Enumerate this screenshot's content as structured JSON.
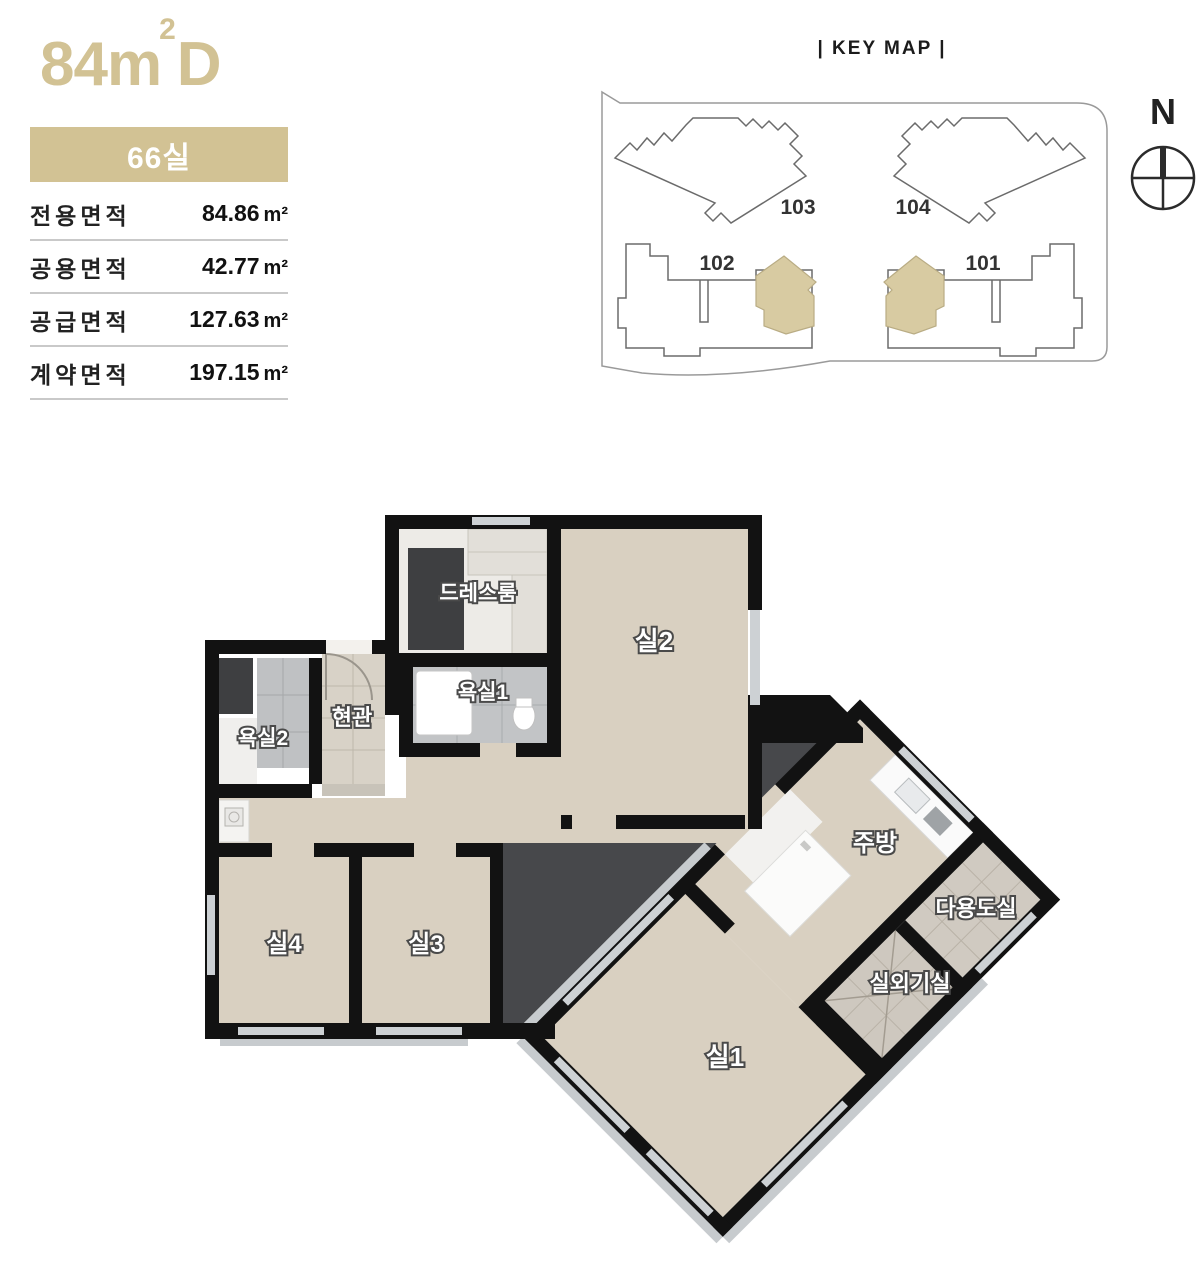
{
  "unit": {
    "title_main": "84m",
    "title_sup": "2",
    "title_suffix": "D",
    "badge_label": "66실",
    "accent_color": "#d2c294"
  },
  "area_table": {
    "rows": [
      {
        "label": "전용면적",
        "value": "84.86",
        "unit": "m²"
      },
      {
        "label": "공용면적",
        "value": "42.77",
        "unit": "m²"
      },
      {
        "label": "공급면적",
        "value": "127.63",
        "unit": "m²"
      },
      {
        "label": "계약면적",
        "value": "197.15",
        "unit": "m²"
      }
    ]
  },
  "keymap": {
    "title": "| KEY MAP |",
    "compass_label": "N",
    "buildings": {
      "b103": "103",
      "b104": "104",
      "b102": "102",
      "b101": "101"
    },
    "highlight_color": "#d8cba2"
  },
  "floorplan": {
    "rooms": {
      "dressroom": "드레스룸",
      "room2": "실2",
      "bath1": "욕실1",
      "entry": "현관",
      "bath2": "욕실2",
      "room4": "실4",
      "room3": "실3",
      "kitchen": "주방",
      "utility": "다용도실",
      "ac_room": "실외기실",
      "room1": "실1"
    },
    "colors": {
      "wall": "#121212",
      "wood": "#d9d0c1",
      "dark_area": "#47484b",
      "bath_tile": "#c2c4c6",
      "entry_tile": "#d8d2c7",
      "window": "#cdd1d4"
    }
  }
}
